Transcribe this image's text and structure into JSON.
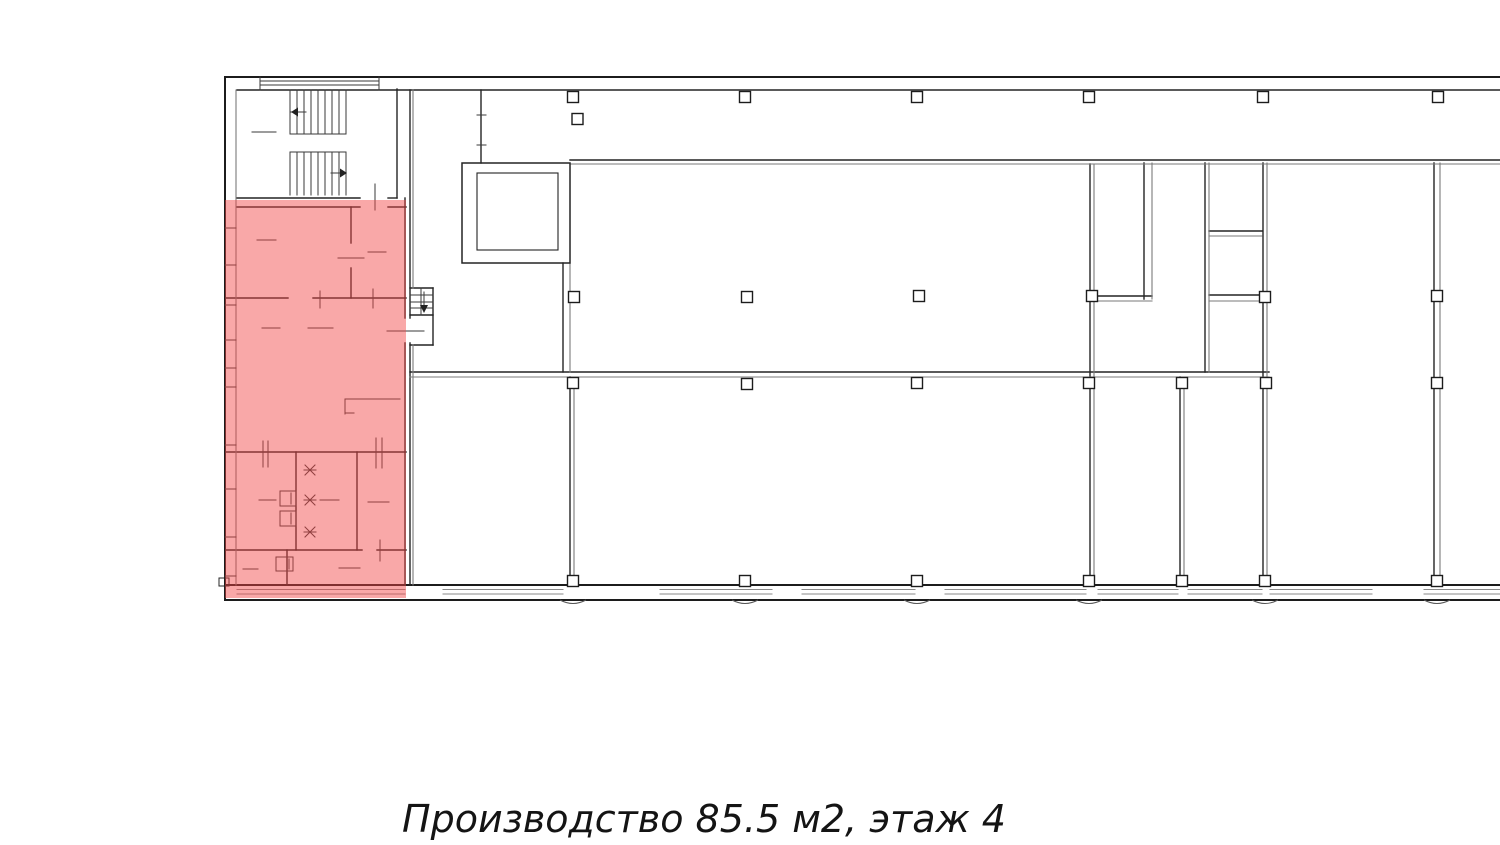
{
  "caption": {
    "text": "Производство 85.5 м2, этаж 4",
    "type_label": "Производство",
    "area_label": "85.5 м2",
    "floor_label": "этаж 4"
  },
  "colors": {
    "background": "#ffffff",
    "wall_dark": "#222222",
    "wall_light": "#7a7a7a",
    "thin": "#3a3a3a",
    "band": "#8a8a8a",
    "column_fill": "#ffffff",
    "highlight_fill": "#f24646"
  },
  "plan": {
    "width": 1500,
    "height": 845,
    "highlight": {
      "x": 225,
      "y": 200,
      "w": 181,
      "h": 398,
      "fill": "#f24646",
      "opacity": 0.47
    },
    "line_groups": [
      {
        "name": "outer-walls",
        "stroke": "#1c1c1c",
        "width": 2,
        "lines": [
          [
            225,
            77,
            1500,
            77
          ],
          [
            225,
            77,
            225,
            600
          ],
          [
            225,
            585,
            1500,
            585
          ],
          [
            225,
            600,
            1500,
            600
          ]
        ]
      },
      {
        "name": "interior-walls",
        "stroke": "#242424",
        "width": 1.4,
        "lines": [
          [
            237,
            90,
            1500,
            90
          ],
          [
            397,
            89,
            397,
            198
          ],
          [
            237,
            198,
            360,
            198
          ],
          [
            388,
            198,
            397,
            198
          ],
          [
            237,
            207,
            360,
            207
          ],
          [
            388,
            207,
            406,
            207
          ],
          [
            351,
            207,
            351,
            243
          ],
          [
            351,
            268,
            351,
            298
          ],
          [
            226,
            298,
            288,
            298
          ],
          [
            313,
            298,
            406,
            298
          ],
          [
            226,
            452,
            406,
            452
          ],
          [
            296,
            452,
            296,
            550
          ],
          [
            357,
            452,
            357,
            550
          ],
          [
            226,
            550,
            362,
            550
          ],
          [
            377,
            550,
            406,
            550
          ],
          [
            287,
            550,
            287,
            585
          ],
          [
            405,
            198,
            405,
            318
          ],
          [
            405,
            343,
            405,
            585
          ],
          [
            410,
            90,
            410,
            318
          ],
          [
            410,
            343,
            410,
            585
          ],
          [
            410,
            288,
            433,
            288
          ],
          [
            433,
            288,
            433,
            345
          ],
          [
            410,
            345,
            433,
            345
          ],
          [
            410,
            315,
            433,
            315
          ],
          [
            481,
            90,
            481,
            163
          ],
          [
            563,
            263,
            563,
            372
          ],
          [
            570,
            160,
            1500,
            160
          ],
          [
            410,
            372,
            1269,
            372
          ],
          [
            570,
            377,
            570,
            585
          ],
          [
            1090,
            164,
            1090,
            585
          ],
          [
            1144,
            163,
            1144,
            299
          ],
          [
            1096,
            296,
            1152,
            296
          ],
          [
            1205,
            163,
            1205,
            372
          ],
          [
            1209,
            231,
            1262,
            231
          ],
          [
            1209,
            295,
            1262,
            295
          ],
          [
            1263,
            163,
            1263,
            578
          ],
          [
            1180,
            377,
            1180,
            585
          ],
          [
            1434,
            163,
            1434,
            585
          ]
        ]
      },
      {
        "name": "interior-walls-light",
        "stroke": "#7a7a7a",
        "width": 1.1,
        "lines": [
          [
            236,
            90,
            236,
            585
          ],
          [
            413,
            90,
            413,
            288
          ],
          [
            413,
            345,
            413,
            585
          ],
          [
            570,
            263,
            570,
            372
          ],
          [
            570,
            164,
            1500,
            164
          ],
          [
            410,
            377,
            1269,
            377
          ],
          [
            574,
            377,
            574,
            585
          ],
          [
            1094,
            164,
            1094,
            585
          ],
          [
            1152,
            163,
            1152,
            299
          ],
          [
            1096,
            301,
            1152,
            301
          ],
          [
            1209,
            163,
            1209,
            372
          ],
          [
            1209,
            236,
            1262,
            236
          ],
          [
            1209,
            301,
            1262,
            301
          ],
          [
            1267,
            163,
            1267,
            578
          ],
          [
            1184,
            377,
            1184,
            585
          ],
          [
            1440,
            163,
            1440,
            585
          ]
        ]
      },
      {
        "name": "window-band-lines",
        "stroke": "#8a8a8a",
        "width": 1,
        "lines": [
          [
            237,
            589.5,
            405,
            589.5
          ],
          [
            237,
            594,
            405,
            594
          ],
          [
            443,
            589.5,
            563,
            589.5
          ],
          [
            443,
            594,
            563,
            594
          ],
          [
            660,
            589.5,
            772,
            589.5
          ],
          [
            660,
            594,
            772,
            594
          ],
          [
            802,
            589.5,
            915,
            589.5
          ],
          [
            802,
            594,
            915,
            594
          ],
          [
            945,
            589.5,
            1086,
            589.5
          ],
          [
            945,
            594,
            1086,
            594
          ],
          [
            1098,
            589.5,
            1178,
            589.5
          ],
          [
            1098,
            594,
            1178,
            594
          ],
          [
            1188,
            589.5,
            1262,
            589.5
          ],
          [
            1188,
            594,
            1262,
            594
          ],
          [
            1270,
            589.5,
            1372,
            589.5
          ],
          [
            1270,
            594,
            1372,
            594
          ],
          [
            1424,
            589.5,
            1500,
            589.5
          ],
          [
            1424,
            594,
            1500,
            594
          ]
        ]
      },
      {
        "name": "thin-details",
        "stroke": "#3a3a3a",
        "width": 1,
        "lines": [
          [
            260,
            81,
            379,
            81
          ],
          [
            260,
            85,
            379,
            85
          ],
          [
            260,
            77,
            260,
            90
          ],
          [
            379,
            77,
            379,
            90
          ],
          [
            290,
            90,
            290,
            134
          ],
          [
            297,
            90,
            297,
            134
          ],
          [
            304,
            90,
            304,
            134
          ],
          [
            311,
            90,
            311,
            134
          ],
          [
            318,
            90,
            318,
            134
          ],
          [
            325,
            90,
            325,
            134
          ],
          [
            332,
            90,
            332,
            134
          ],
          [
            339,
            90,
            339,
            134
          ],
          [
            346,
            90,
            346,
            134
          ],
          [
            290,
            134,
            346,
            134
          ],
          [
            290,
            152,
            346,
            152
          ],
          [
            290,
            152,
            290,
            195
          ],
          [
            297,
            152,
            297,
            195
          ],
          [
            304,
            152,
            304,
            195
          ],
          [
            311,
            152,
            311,
            195
          ],
          [
            318,
            152,
            318,
            195
          ],
          [
            325,
            152,
            325,
            195
          ],
          [
            332,
            152,
            332,
            195
          ],
          [
            339,
            152,
            339,
            195
          ],
          [
            346,
            152,
            346,
            195
          ],
          [
            306,
            112,
            291,
            112
          ],
          [
            331,
            173,
            346,
            173
          ],
          [
            424,
            292,
            424,
            309
          ],
          [
            410,
            295,
            433,
            295
          ],
          [
            410,
            302,
            433,
            302
          ],
          [
            410,
            308,
            433,
            308
          ],
          [
            421,
            288,
            421,
            315
          ],
          [
            252,
            132,
            276,
            132
          ],
          [
            257,
            240,
            276,
            240
          ],
          [
            338,
            258,
            364,
            258
          ],
          [
            368,
            252,
            386,
            252
          ],
          [
            262,
            328,
            280,
            328
          ],
          [
            308,
            328,
            333,
            328
          ],
          [
            387,
            331,
            424,
            331
          ],
          [
            259,
            500,
            276,
            500
          ],
          [
            320,
            500,
            339,
            500
          ],
          [
            243,
            569,
            258,
            569
          ],
          [
            339,
            568,
            360,
            568
          ],
          [
            368,
            502,
            389,
            502
          ],
          [
            375,
            184,
            375,
            210
          ],
          [
            320,
            291,
            320,
            308
          ],
          [
            373,
            289,
            373,
            308
          ],
          [
            263,
            441,
            263,
            467
          ],
          [
            268,
            441,
            268,
            467
          ],
          [
            376,
            438,
            376,
            468
          ],
          [
            382,
            438,
            382,
            468
          ],
          [
            380,
            540,
            380,
            561
          ],
          [
            477,
            115,
            486,
            115
          ],
          [
            477,
            145,
            486,
            145
          ],
          [
            345,
            399,
            400,
            399
          ],
          [
            345,
            399,
            345,
            414
          ],
          [
            345,
            413,
            354,
            413
          ],
          [
            291,
            493,
            291,
            504
          ],
          [
            291,
            513,
            291,
            524
          ],
          [
            289,
            559,
            289,
            569
          ],
          [
            225,
            228,
            236,
            228
          ],
          [
            225,
            265,
            236,
            265
          ],
          [
            225,
            305,
            236,
            305
          ],
          [
            225,
            340,
            236,
            340
          ],
          [
            225,
            368,
            236,
            368
          ],
          [
            225,
            387,
            236,
            387
          ],
          [
            225,
            445,
            236,
            445
          ],
          [
            225,
            489,
            236,
            489
          ],
          [
            225,
            537,
            236,
            537
          ],
          [
            225,
            576,
            236,
            576
          ],
          [
            304,
            470,
            316,
            470
          ],
          [
            305,
            465,
            315,
            475
          ],
          [
            305,
            475,
            315,
            465
          ],
          [
            304,
            500,
            316,
            500
          ],
          [
            305,
            495,
            315,
            505
          ],
          [
            305,
            505,
            315,
            495
          ],
          [
            304,
            532,
            316,
            532
          ],
          [
            305,
            527,
            315,
            537
          ],
          [
            305,
            537,
            315,
            527
          ]
        ]
      }
    ],
    "rects": [
      {
        "name": "elevator-shaft-outer",
        "x": 462,
        "y": 163,
        "w": 108,
        "h": 100,
        "stroke": "#242424",
        "width": 1.5
      },
      {
        "name": "elevator-shaft-inner",
        "x": 477,
        "y": 173,
        "w": 81,
        "h": 77,
        "stroke": "#242424",
        "width": 1.1
      },
      {
        "name": "sanitary-fixture",
        "x": 280,
        "y": 491,
        "w": 16,
        "h": 15,
        "stroke": "#3a3a3a",
        "width": 1
      },
      {
        "name": "sanitary-fixture",
        "x": 280,
        "y": 511,
        "w": 16,
        "h": 15,
        "stroke": "#3a3a3a",
        "width": 1
      },
      {
        "name": "sanitary-fixture",
        "x": 276,
        "y": 557,
        "w": 17,
        "h": 14,
        "stroke": "#3a3a3a",
        "width": 1
      },
      {
        "name": "wall-notch",
        "x": 219,
        "y": 578,
        "w": 10,
        "h": 8,
        "stroke": "#242424",
        "width": 1
      }
    ],
    "columns": {
      "size": 11,
      "stroke": "#1c1c1c",
      "centers": [
        [
          573,
          97
        ],
        [
          745,
          97
        ],
        [
          917,
          97
        ],
        [
          1089,
          97
        ],
        [
          1263,
          97
        ],
        [
          1438,
          97
        ],
        [
          577.5,
          119
        ],
        [
          574,
          297
        ],
        [
          747,
          297
        ],
        [
          919,
          296
        ],
        [
          1092,
          296
        ],
        [
          1265,
          297
        ],
        [
          1437,
          296
        ],
        [
          573,
          383
        ],
        [
          747,
          384
        ],
        [
          917,
          383
        ],
        [
          1089,
          383
        ],
        [
          1182,
          383
        ],
        [
          1266,
          383
        ],
        [
          1437,
          383
        ],
        [
          573,
          581
        ],
        [
          745,
          581
        ],
        [
          917,
          581
        ],
        [
          1089,
          581
        ],
        [
          1182,
          581
        ],
        [
          1265,
          581
        ],
        [
          1437,
          581
        ]
      ]
    },
    "arrowheads": [
      {
        "name": "stair-up-arrowhead",
        "points": [
          [
            291,
            112
          ],
          [
            298,
            107.5
          ],
          [
            298,
            116.5
          ]
        ]
      },
      {
        "name": "stair-down-arrowhead",
        "points": [
          [
            347,
            173
          ],
          [
            340,
            168.5
          ],
          [
            340,
            177.5
          ]
        ]
      },
      {
        "name": "service-stair-arrowhead",
        "points": [
          [
            424,
            313
          ],
          [
            420,
            305
          ],
          [
            428,
            305
          ]
        ]
      }
    ],
    "sill_marks": {
      "xs": [
        573,
        745,
        917,
        1089,
        1265,
        1437
      ],
      "y": 600,
      "half_width": 13,
      "depth": 7
    }
  }
}
